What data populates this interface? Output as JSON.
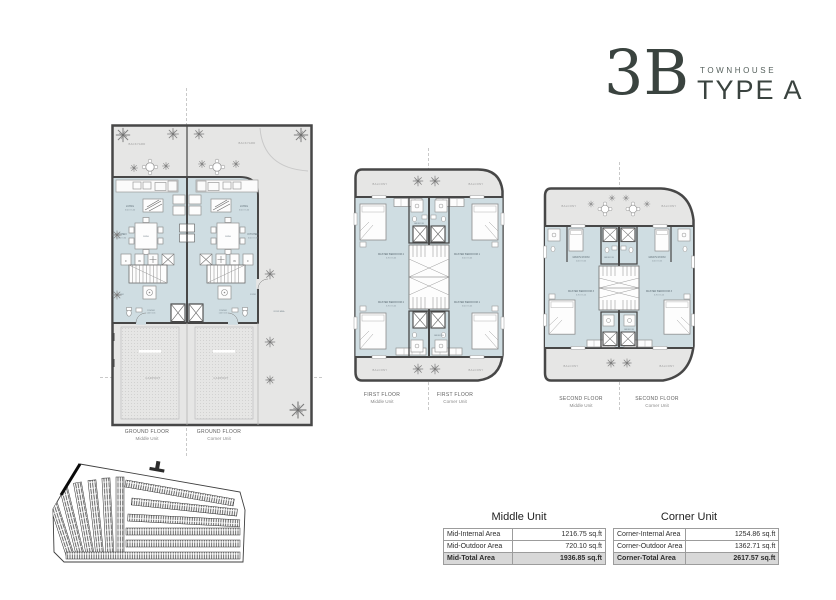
{
  "title": {
    "number": "3B",
    "category": "TOWNHOUSE",
    "type_label": "TYPE A"
  },
  "plans": {
    "ground": {
      "captions": [
        {
          "floor": "GROUND FLOOR",
          "unit": "Middle Unit"
        },
        {
          "floor": "GROUND FLOOR",
          "unit": "Corner Unit"
        }
      ],
      "labels": {
        "backyard": "BACKYARD",
        "living": "LIVING",
        "living_dims": "3.50 X 5.50",
        "kitchen": "KITCHEN",
        "kitchen_dims": "3.50 X 3.30",
        "dining": "DINING",
        "foyer": "FOYER",
        "powder": "POWDER",
        "powder_dims": "1.40 X 1.55",
        "carport": "CARPORT",
        "front_area": "FRONT AREA",
        "appliance_f": "F",
        "appliance_w": "W"
      }
    },
    "first": {
      "captions": [
        {
          "floor": "FIRST FLOOR",
          "unit": "Middle Unit"
        },
        {
          "floor": "FIRST FLOOR",
          "unit": "Corner Unit"
        }
      ],
      "labels": {
        "balcony": "BALCONY",
        "master1": "MASTER BEDROOM 1",
        "master1_dims": "3.50 X 5.05",
        "master2": "MASTER BEDROOM 2",
        "master2_dims": "3.70 X 5.05",
        "bathroom": "BATHROOM"
      }
    },
    "second": {
      "captions": [
        {
          "floor": "SECOND FLOOR",
          "unit": "Middle Unit"
        },
        {
          "floor": "SECOND FLOOR",
          "unit": "Corner Unit"
        }
      ],
      "labels": {
        "balcony": "BALCONY",
        "maid": "MAID'S ROOM",
        "maid_dims": "2.00 X 3.25",
        "master3": "MASTER BEDROOM 3",
        "master3_dims": "3.70 X 5.15",
        "bathroom": "BATHROOM"
      }
    }
  },
  "tables": {
    "middle": {
      "title": "Middle Unit",
      "rows": [
        [
          "Mid-Internal Area",
          "1216.75 sq.ft"
        ],
        [
          "Mid-Outdoor Area",
          "720.10 sq.ft"
        ],
        [
          "Mid-Total Area",
          "1936.85 sq.ft"
        ]
      ]
    },
    "corner": {
      "title": "Corner Unit",
      "rows": [
        [
          "Corner-Internal Area",
          "1254.86 sq.ft"
        ],
        [
          "Corner-Outdoor Area",
          "1362.71 sq.ft"
        ],
        [
          "Corner-Total Area",
          "2617.57 sq.ft"
        ]
      ]
    }
  },
  "colors": {
    "wall": "#474747",
    "interior": "#cfdde2",
    "outdoor": "#e6e6e5",
    "accent_text": "#3a433f"
  }
}
